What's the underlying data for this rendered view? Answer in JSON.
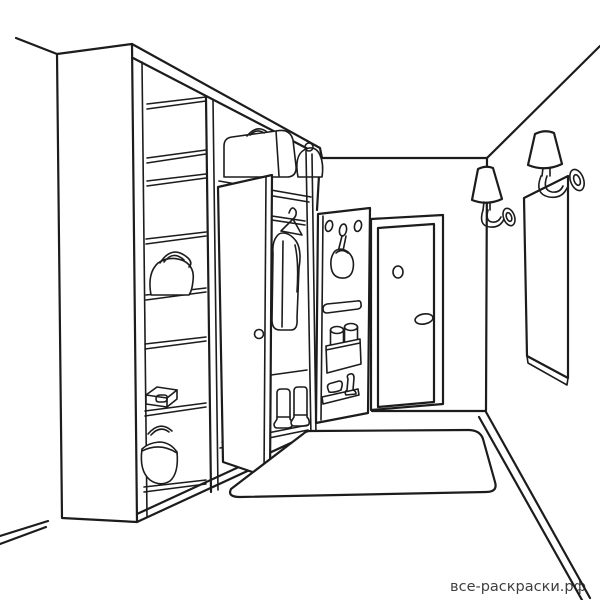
{
  "colors": {
    "paper": "#ffffff",
    "line": "#1c1c1c",
    "watermark": "#3f3f3f"
  },
  "watermark": {
    "text": "все-раскраски.рф"
  },
  "scene": {
    "type": "line-art coloring page",
    "subject": "hallway (entryway) interior",
    "objects": [
      "room corner with ceiling lines",
      "tall cabinet against left wall",
      "open shelving unit with jug, flat box and basket",
      "wardrobe top shelf with suitcase and small bag",
      "hanging rod with coat on hanger",
      "pair of boots on wardrobe floor",
      "open wardrobe door with round knob",
      "door-back organizer: hook holes, hanging flask, slot shelf, pocket with two cans, small shelf with brush and shoehorn",
      "entrance door with peephole and handle",
      "two cone-shade wall sconces",
      "tall wall mirror",
      "large floor rug",
      "baseboards along left and right walls"
    ]
  }
}
